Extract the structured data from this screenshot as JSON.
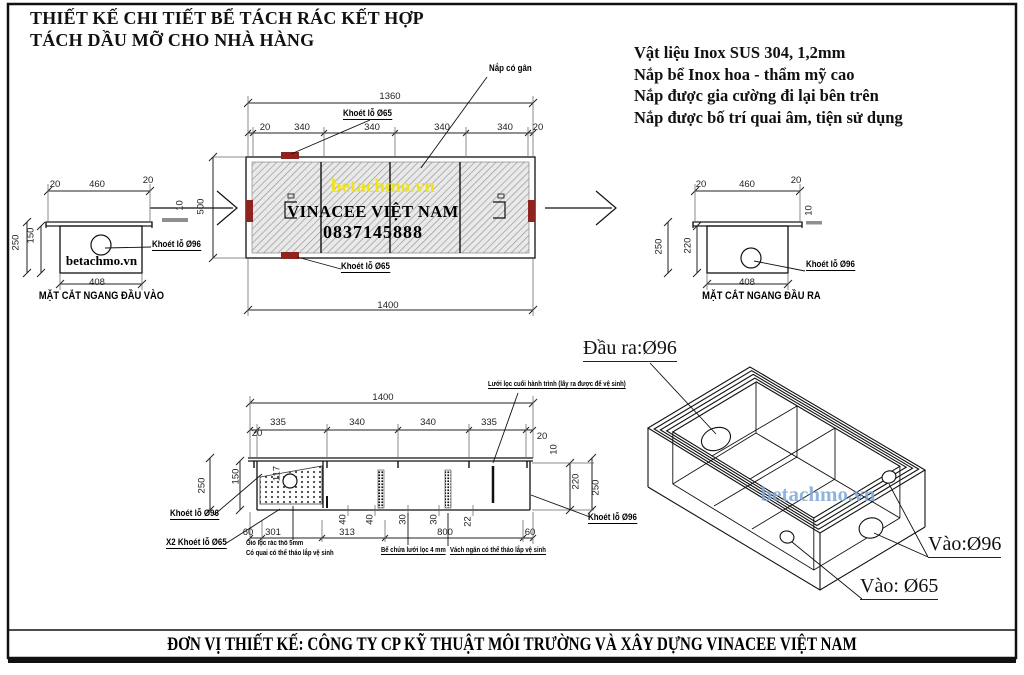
{
  "title": {
    "line1": "THIẾT KẾ CHI TIẾT BỂ TÁCH RÁC KẾT HỢP",
    "line2": "TÁCH DẦU MỠ CHO NHÀ HÀNG"
  },
  "specs": [
    "Vật liệu Inox SUS 304, 1,2mm",
    "Nắp bể Inox hoa - thẩm mỹ cao",
    "Nắp được gia cường đi lại bên trên",
    "Nắp được bố trí quai âm, tiện sử dụng"
  ],
  "plan": {
    "dim_top": "1360",
    "segs": [
      "20",
      "340",
      "340",
      "340",
      "340",
      "20"
    ],
    "dim_bottom": "1400",
    "dim_height": "500",
    "dim_lip": "10",
    "hole_top": "Khoét lỗ Ø65",
    "hole_bottom": "Khoét lỗ Ø65",
    "lid_note": "Nắp có gân",
    "watermark": "betachmo.vn",
    "company": "VINACEE VIỆT NAM",
    "phone": "0837145888"
  },
  "section_in": {
    "caption": "MẶT CẮT NGANG ĐẦU VÀO",
    "d20a": "20",
    "d460": "460",
    "d20b": "20",
    "d250": "250",
    "d150": "150",
    "d408": "408",
    "hole": "Khoét lỗ Ø96",
    "watermark": "betachmo.vn"
  },
  "section_out": {
    "caption": "MẶT CẮT NGANG ĐẦU RA",
    "d20a": "20",
    "d460": "460",
    "d20b": "20",
    "d250": "250",
    "d220": "220",
    "d10": "10",
    "d408": "408",
    "hole": "Khoét lỗ Ø96"
  },
  "long_section": {
    "dim_top": "1400",
    "segs": [
      "20",
      "335",
      "340",
      "340",
      "335",
      "20"
    ],
    "d117": "117",
    "d150": "150",
    "d250l": "250",
    "d20r": "20",
    "d10r": "10",
    "d220": "220",
    "d250r": "250",
    "inner": [
      "40",
      "40",
      "30",
      "30",
      "22"
    ],
    "bottom": [
      "60",
      "301",
      "313",
      "800",
      "60"
    ],
    "filter_note": "Lưới lọc cuối hành trình (lấy ra được để vệ sinh)",
    "hole_left": "Khoét lỗ Ø96",
    "hole_left2": "X2 Khoét lỗ Ø65",
    "hole_right": "Khoét lỗ Ø96",
    "note1": "Giỏ lọc rác thô 5mm",
    "note2": "Có quai có thể tháo lắp vệ sinh",
    "note3": "Bể chứa lưới lọc 4 mm",
    "note4": "Vách ngăn có thể tháo lắp vệ sinh"
  },
  "iso": {
    "out96": "Đầu ra:Ø96",
    "in96": "Vào:Ø96",
    "in65": "Vào: Ø65",
    "watermark": "betachmo.vn"
  },
  "footer": "ĐƠN VỊ THIẾT KẾ: CÔNG TY CP KỸ THUẬT MÔI TRƯỜNG VÀ XÂY DỰNG VINACEE VIỆT NAM",
  "colors": {
    "red_mark": "#8e2420",
    "watermark_yellow": "#f0e319",
    "watermark_blue": "#7ea7d8"
  }
}
